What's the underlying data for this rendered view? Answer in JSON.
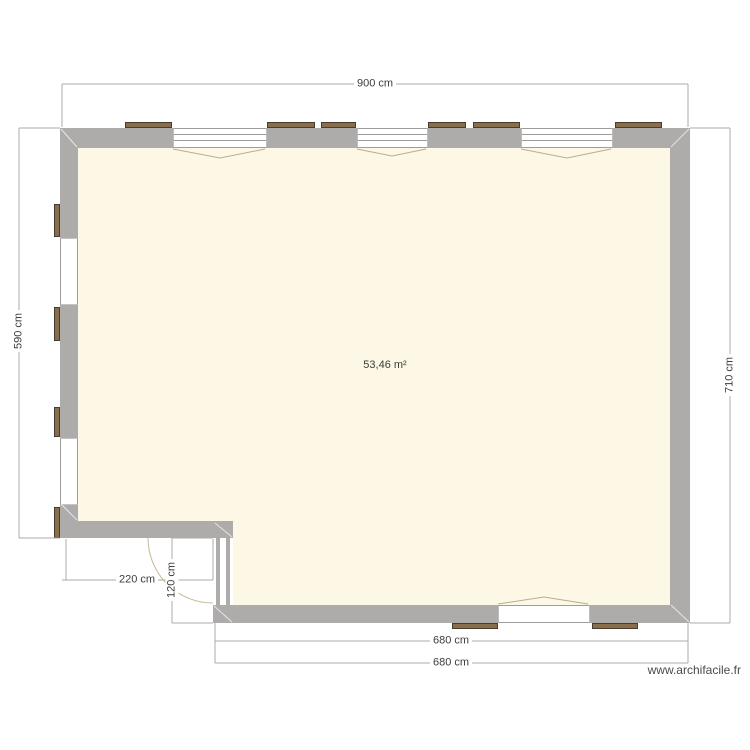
{
  "plan": {
    "area_label": "53,46 m²",
    "watermark": "www.archifacile.fr",
    "dimensions": {
      "top_width": "900 cm",
      "left_height": "590 cm",
      "right_height": "710 cm",
      "notch_width": "220 cm",
      "notch_depth": "120 cm",
      "bottom_width_1": "680 cm",
      "bottom_width_2": "680 cm"
    },
    "colors": {
      "wall": "#aeabab",
      "floor": "#fcf8e5",
      "shutter": "#8a6e49",
      "shutter_border": "#433d32",
      "window_line": "#9c9c9c",
      "dim_line": "#ababab",
      "label_text": "#3c3c3c",
      "chevron": "#b6ad97",
      "door_arc": "#c9b795",
      "watermark_text": "#4a4a4a"
    }
  }
}
